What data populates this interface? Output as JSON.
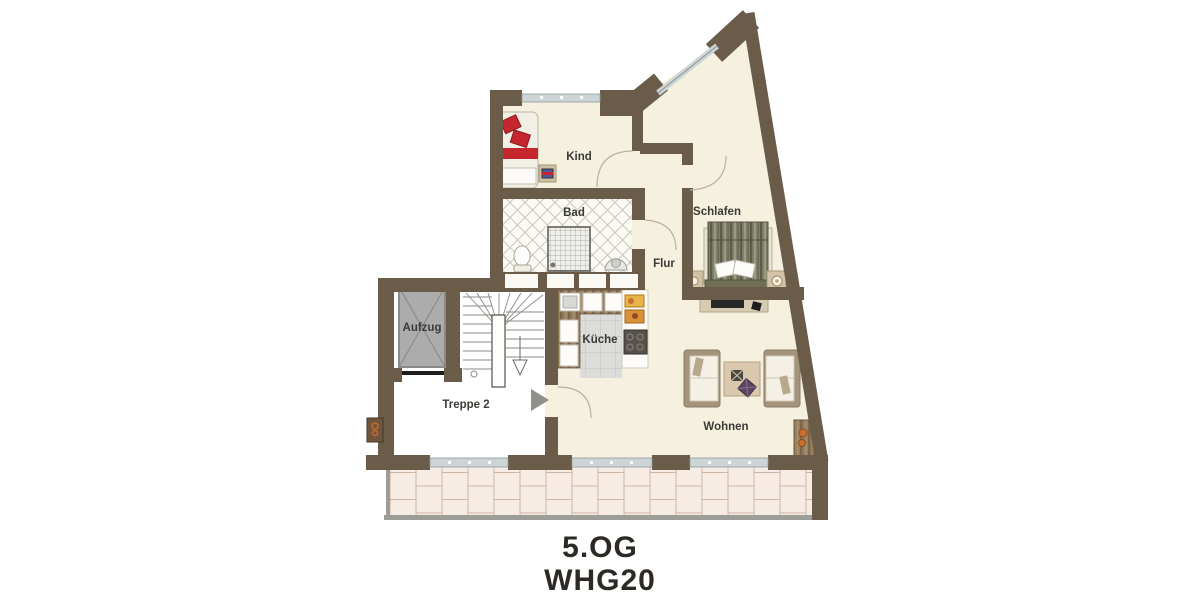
{
  "floorplan": {
    "title_line1": "5.OG",
    "title_line2": "WHG20",
    "rooms": {
      "kind": {
        "label": "Kind"
      },
      "bad": {
        "label": "Bad"
      },
      "schlafen": {
        "label": "Schlafen"
      },
      "flur": {
        "label": "Flur"
      },
      "kueche": {
        "label": "Küche"
      },
      "wohnen": {
        "label": "Wohnen"
      },
      "aufzug": {
        "label": "Aufzug"
      },
      "treppe": {
        "label": "Treppe 2"
      }
    },
    "colors": {
      "wall": "#6a5c49",
      "floor": "#f6f0df",
      "terrace_tile": "#f7ece4",
      "terrace_grout": "#cdb5a5",
      "railing": "#9d9d97",
      "accent_red": "#c4272e",
      "bed_olive": "#80806a",
      "label_text": "#3a3a36"
    }
  }
}
